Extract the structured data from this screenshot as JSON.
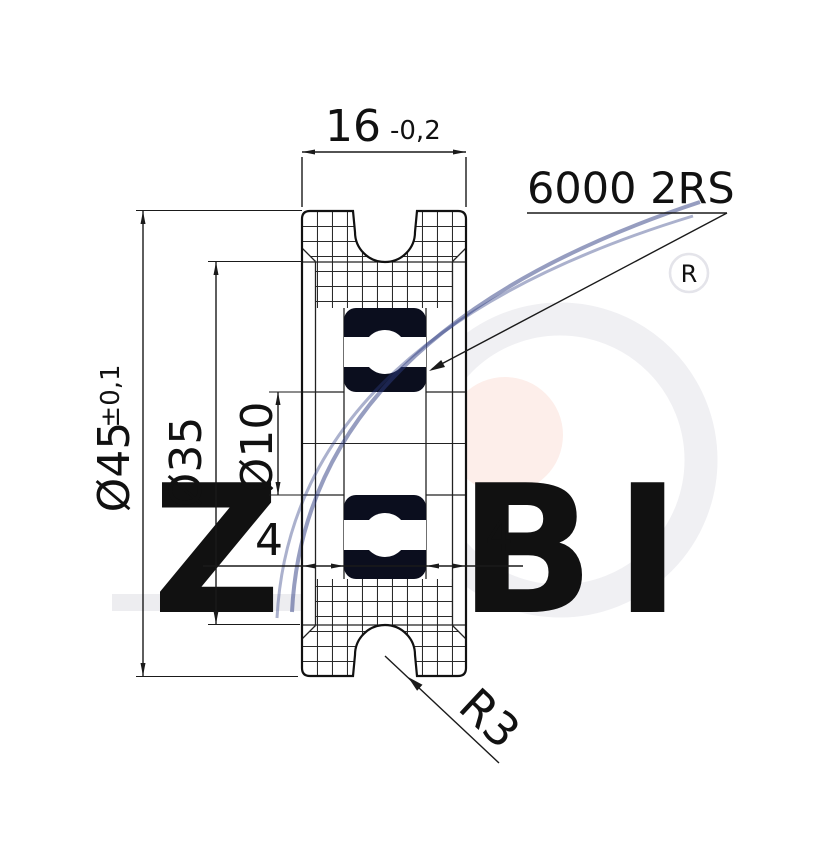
{
  "drawing": {
    "width_dim": {
      "value": "16",
      "tolerance": "-0,2"
    },
    "bearing": {
      "designation": "6000 2RS"
    },
    "outer_diameter": {
      "value": "Ø45",
      "tolerance": "±0,1"
    },
    "groove_diameter": {
      "value": "Ø35"
    },
    "bore_diameter": {
      "value": "Ø10"
    },
    "offset_left": {
      "value": "4"
    },
    "offset_right": {
      "value": "4"
    },
    "groove_radius": {
      "value": "R3"
    }
  },
  "watermark": {
    "brand": "ZABI",
    "registered": "R"
  },
  "colors": {
    "line": "#1a1a1a",
    "bearing_fill": "#0b0e1e",
    "watermark_gray": "#ededf1",
    "watermark_pink": "#fdeeea",
    "watermark_ring": "#f0f0f3",
    "watermark_navy": "#2d3c82"
  }
}
